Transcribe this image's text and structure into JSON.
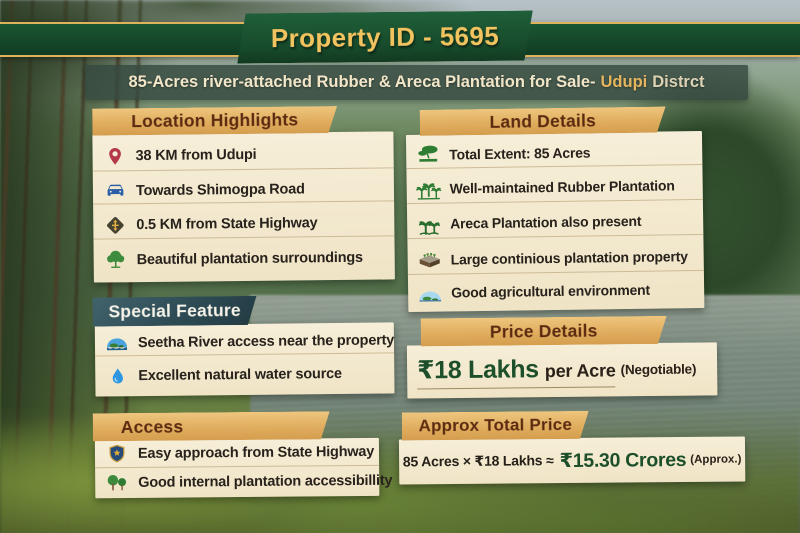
{
  "header": {
    "property_id": "Property ID - 5695",
    "subtitle_main": "85-Acres river-attached Rubber & Areca Plantation for Sale-",
    "subtitle_location": "Udupi",
    "subtitle_suffix": "Distrct"
  },
  "sections": {
    "location_highlights": {
      "title": "Location Highlights",
      "items": [
        {
          "icon": "map-pin-icon",
          "text": "38 KM from Udupi"
        },
        {
          "icon": "car-icon",
          "text": "Towards Shimogpa Road"
        },
        {
          "icon": "road-sign-icon",
          "text": "0.5 KM from State Highway"
        },
        {
          "icon": "tree-icon",
          "text": "Beautiful plantation surroundings"
        }
      ]
    },
    "special_feature": {
      "title": "Special Feature",
      "items": [
        {
          "icon": "river-icon",
          "text": "Seetha River access near the property"
        },
        {
          "icon": "water-drop-icon",
          "text": "Excellent natural water source"
        }
      ]
    },
    "access": {
      "title": "Access",
      "items": [
        {
          "icon": "shield-icon",
          "text": "Easy approach from State Highway"
        },
        {
          "icon": "two-trees-icon",
          "text": "Good internal plantation accessibillity"
        }
      ]
    },
    "land_details": {
      "title": "Land Details",
      "items": [
        {
          "icon": "land-extent-icon",
          "text": "Total Extent: 85 Acres"
        },
        {
          "icon": "rubber-plantation-icon",
          "text": "Well-maintained Rubber Plantation"
        },
        {
          "icon": "areca-palm-icon",
          "text": "Areca Plantation also present"
        },
        {
          "icon": "planter-bed-icon",
          "text": "Large continious plantation property"
        },
        {
          "icon": "landscape-icon",
          "text": "Good agricultural environment"
        }
      ]
    },
    "price_details": {
      "title": "Price Details",
      "price_value": "₹18 Lakhs",
      "price_unit": "per Acre",
      "price_note": "(Negotiable)"
    },
    "approx_total_price": {
      "title": "Approx Total Price",
      "formula": "85 Acres × ₹18 Lakhs ≈",
      "total_value": "₹15.30 Crores",
      "total_note": "(Approx.)"
    }
  },
  "colors": {
    "band_green": "#174a2c",
    "ribbon_gold_text": "#f2c35f",
    "banner_gold": "#dfab5c",
    "banner_teal": "#2b4750",
    "banner_text_maroon": "#5b2a10",
    "panel_cream": "#f3e9ce",
    "price_green": "#1d4f2a",
    "subtitle_bar": "#34483e"
  }
}
